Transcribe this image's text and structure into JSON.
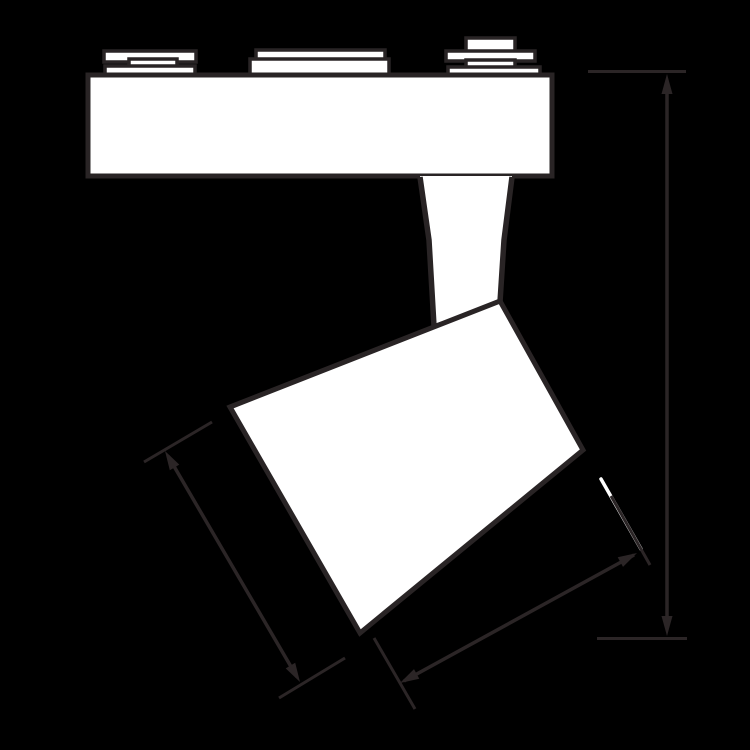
{
  "page": {
    "kind": "technical-dimension-drawing",
    "subject": "LED track spotlight, side elevation line drawing",
    "text_labels": []
  },
  "colors": {
    "background": "#000000",
    "outline": "#292425",
    "fill": "#ffffff",
    "dimension": "#2b2526",
    "highlight": "#ffffff"
  },
  "parts": {
    "track_rail": "track adapter rail",
    "track_contacts": "track contact plates (three stacks)",
    "stem": "tapered mounting stem",
    "lamp_head": "tilted cylindrical lamp head"
  },
  "dimensions": {
    "overall_height": "vertical extent from rail top to head bottom",
    "head_length": "length of head along its left side",
    "face_width": "width of head front face"
  }
}
